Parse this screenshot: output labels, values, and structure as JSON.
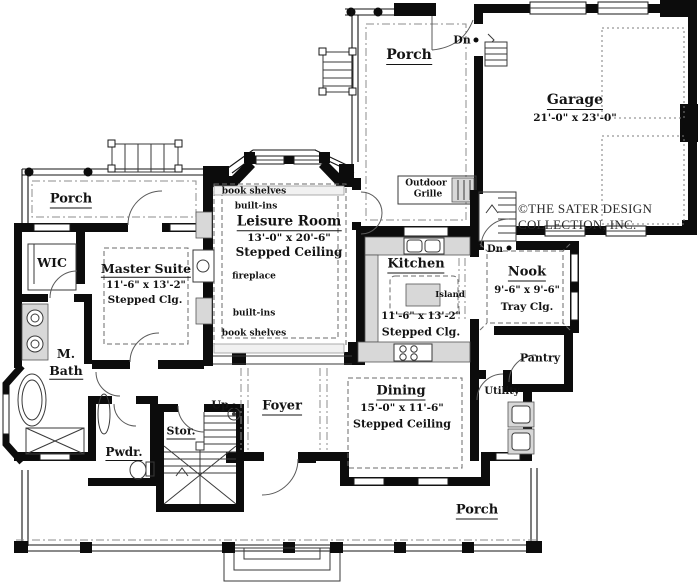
{
  "plan": {
    "rooms": {
      "porch_top": {
        "label": "Porch"
      },
      "porch_left": {
        "label": "Porch"
      },
      "porch_bottom": {
        "label": "Porch"
      },
      "garage": {
        "label": "Garage",
        "dims": "21'-0\" x 23'-0\""
      },
      "leisure": {
        "label": "Leisure Room",
        "dims": "13'-0\" x 20'-6\"",
        "ceiling": "Stepped Ceiling"
      },
      "master": {
        "label": "Master Suite",
        "dims": "11'-6\" x 13'-2\"",
        "ceiling": "Stepped Clg."
      },
      "kitchen": {
        "label": "Kitchen",
        "dims": "11'-6\" x 13'-2\"",
        "ceiling": "Stepped Clg."
      },
      "nook": {
        "label": "Nook",
        "dims": "9'-6\" x 9'-6\"",
        "ceiling": "Tray Clg."
      },
      "dining": {
        "label": "Dining",
        "dims": "15'-0\" x 11'-6\"",
        "ceiling": "Stepped Ceiling"
      },
      "foyer": {
        "label": "Foyer"
      },
      "wic": {
        "label": "WIC"
      },
      "m_bath": {
        "line1": "M.",
        "line2": "Bath"
      },
      "pwdr": {
        "label": "Pwdr."
      },
      "stor": {
        "label": "Stor."
      },
      "utility": {
        "label": "Utility"
      },
      "pantry": {
        "label": "Pantry"
      }
    },
    "annotations": {
      "book_shelves_top": "book shelves",
      "built_ins_top": "built-ins",
      "fireplace": "fireplace",
      "built_ins_bottom": "built-ins",
      "book_shelves_bottom": "book shelves",
      "island": "Island",
      "outdoor_grille_line1": "Outdoor",
      "outdoor_grille_line2": "Grille",
      "up": "Up",
      "dn_garage": "Dn",
      "dn_nook": "Dn"
    },
    "copyright": {
      "line1": "©THE SATER DESIGN",
      "line2": "COLLECTION, INC."
    },
    "colors": {
      "wall": "#0c0c0c",
      "fixture_gray": "#d8d8d8",
      "background": "#ffffff"
    }
  }
}
